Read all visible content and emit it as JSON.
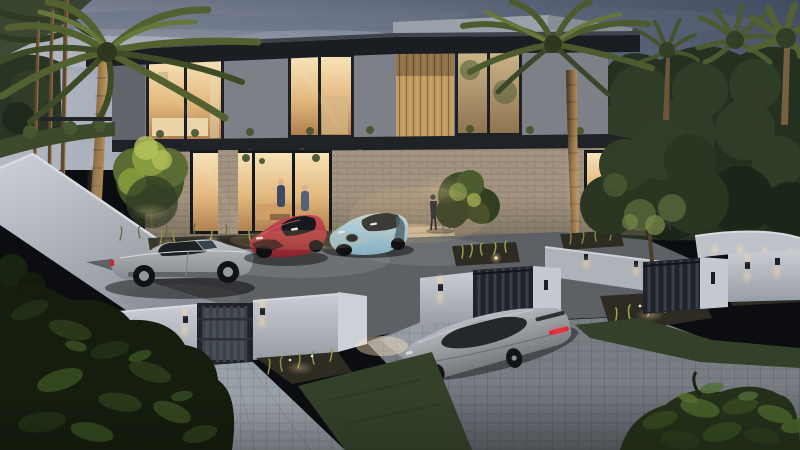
{
  "scene": {
    "type": "architectural-render",
    "setting": "modern two-storey luxury villa at dusk with lit interiors, palm trees, landscaped boundary walls, gates and a paver driveway",
    "time_of_day": "dusk",
    "people_count": 2,
    "cars": [
      {
        "id": "silver-convertible",
        "color_name": "silver",
        "hi": "#bcbec2",
        "lo": "#85888c"
      },
      {
        "id": "red-supercar",
        "color_name": "red",
        "hi": "#cc4a53",
        "lo": "#8a222b"
      },
      {
        "id": "blue-supercar",
        "color_name": "light blue",
        "hi": "#bcd7e1",
        "lo": "#88b0c1"
      },
      {
        "id": "grey-coupe",
        "color_name": "grey",
        "hi": "#b9bdc2",
        "lo": "#75797e"
      }
    ]
  },
  "palette": {
    "sky_left": "#b4bac4",
    "sky_mid": "#8b93a3",
    "sky_right": "#4c5668",
    "cloud": "#687285",
    "trees_dark": "#243020",
    "trees_mid": "#32402a",
    "roof": "#1a1d21",
    "roof_top": "#3f444b",
    "parapet": "#9aa1ab",
    "stucco": "#7e8088",
    "stucco_shade": "#63656d",
    "slab": "#1f2226",
    "stone": "#a29480",
    "wood": "#c09a61",
    "pillar": "#c6cad0",
    "gate_dark": "#20242a",
    "gate_slat": "#3a4148",
    "asphalt": "#5d6065",
    "paver_light": "#9aa0a7",
    "paver_mid": "#787d84",
    "grass": "#33402a",
    "bed_soil": "#2e2b22",
    "plant_lit": "#97a24b",
    "flower_white": "#e9e9e0",
    "palm_frond": "#52612f",
    "palm_frond_dark": "#3e4b27",
    "trunk_lit": "#c79c60",
    "glow": "#ffdca6",
    "interior_hi": "#f7e3b8",
    "interior_lo": "#b08050",
    "taillight": "#d0232e",
    "people_dark": "#23262e",
    "people_suit": "#8d9094"
  }
}
